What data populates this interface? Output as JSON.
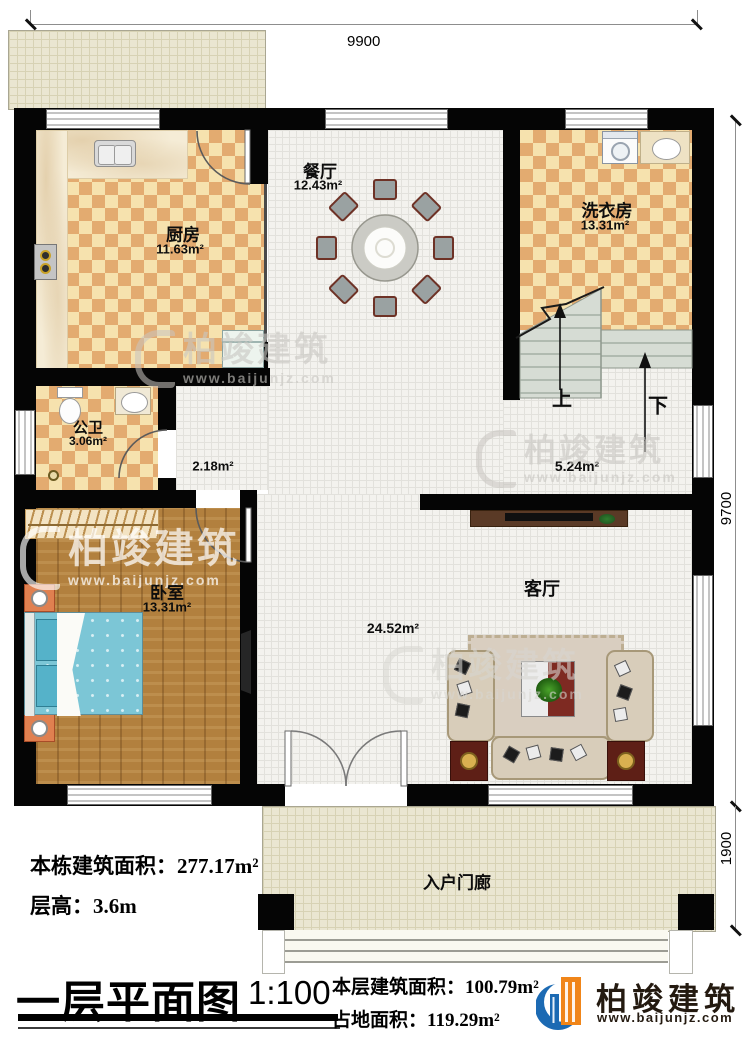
{
  "plan": {
    "dimensions": {
      "width_top": "9900",
      "height_right": "9700",
      "porch_depth": "1900"
    },
    "rooms": {
      "kitchen": {
        "name": "厨房",
        "area": "11.63m²"
      },
      "dining": {
        "name": "餐厅",
        "area": "12.43m²"
      },
      "laundry": {
        "name": "洗衣房",
        "area": "13.31m²"
      },
      "bathroom": {
        "name": "公卫",
        "area": "3.06m²"
      },
      "hallway": {
        "area": "2.18m²"
      },
      "stair_hall": {
        "area": "5.24m²"
      },
      "bedroom": {
        "name": "卧室",
        "area": "13.31m²"
      },
      "living_room": {
        "name": "客厅",
        "area": "24.52m²"
      },
      "entry_porch": {
        "name": "入户门廊"
      }
    },
    "stairs": {
      "up": "上",
      "down": "下"
    }
  },
  "annotations": {
    "total_building_area": "本栋建筑面积：277.17m²",
    "floor_height": "层高：3.6m"
  },
  "title_block": {
    "title": "一层平面图",
    "scale": "1:100",
    "floor_area": "本层建筑面积：100.79m²",
    "footprint_area": "占地面积：119.29m²"
  },
  "branding": {
    "company": "柏竣建筑",
    "website": "www.baijunjz.com"
  }
}
